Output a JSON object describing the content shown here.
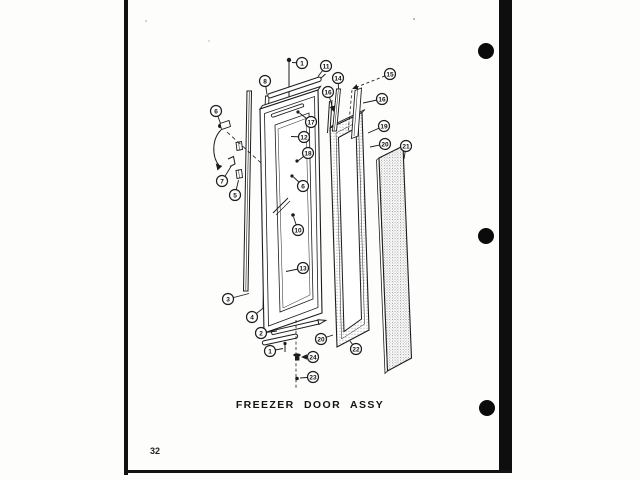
{
  "page": {
    "title": "FREEZER DOOR ASSY",
    "page_number": "32"
  },
  "diagram": {
    "name": "freezer-door-assembly-exploded-view",
    "ink_color": "#1c1c1c",
    "callouts": [
      {
        "label": "1",
        "cx": 302,
        "cy": 63,
        "tx": 292,
        "ty": 62.5
      },
      {
        "label": "11",
        "cx": 326,
        "cy": 66,
        "tx": 318,
        "ty": 76.5
      },
      {
        "label": "8",
        "cx": 265,
        "cy": 81,
        "tx": 267,
        "ty": 94.5
      },
      {
        "label": "14",
        "cx": 338,
        "cy": 78,
        "tx": 338.5,
        "ty": 88.5
      },
      {
        "label": "15",
        "cx": 390,
        "cy": 74,
        "tx": 353,
        "ty": 88.5,
        "dashed": true,
        "arrow": true
      },
      {
        "label": "16",
        "cx": 328,
        "cy": 92,
        "tx": 333.5,
        "ty": 111,
        "arrow": true
      },
      {
        "label": "16",
        "cx": 382,
        "cy": 99,
        "tx": 363,
        "ty": 103
      },
      {
        "label": "17",
        "cx": 311,
        "cy": 122,
        "tx": 299.5,
        "ty": 113
      },
      {
        "label": "12",
        "cx": 304,
        "cy": 137,
        "tx": 291,
        "ty": 136.5
      },
      {
        "label": "18",
        "cx": 308,
        "cy": 153,
        "tx": 298.5,
        "ty": 160.5
      },
      {
        "label": "6",
        "cx": 303,
        "cy": 186,
        "tx": 293.5,
        "ty": 177
      },
      {
        "label": "6",
        "cx": 216,
        "cy": 111,
        "tx": 220.5,
        "ty": 123.5
      },
      {
        "label": "7",
        "cx": 222,
        "cy": 181,
        "tx": 231,
        "ty": 166.5
      },
      {
        "label": "5",
        "cx": 235,
        "cy": 195,
        "tx": 238.5,
        "ty": 180
      },
      {
        "label": "10",
        "cx": 298,
        "cy": 230,
        "tx": 293.5,
        "ty": 217
      },
      {
        "label": "13",
        "cx": 303,
        "cy": 268,
        "tx": 286,
        "ty": 271.5
      },
      {
        "label": "3",
        "cx": 228,
        "cy": 299,
        "tx": 249,
        "ty": 293.5
      },
      {
        "label": "4",
        "cx": 252,
        "cy": 317,
        "tx": 264,
        "ty": 307.5
      },
      {
        "label": "2",
        "cx": 261,
        "cy": 333,
        "tx": 277,
        "ty": 331
      },
      {
        "label": "1",
        "cx": 270,
        "cy": 351,
        "tx": 283,
        "ty": 348.5
      },
      {
        "label": "20",
        "cx": 321,
        "cy": 339,
        "tx": 333,
        "ty": 335
      },
      {
        "label": "22",
        "cx": 356,
        "cy": 349,
        "tx": 350,
        "ty": 341
      },
      {
        "label": "24",
        "cx": 313,
        "cy": 357,
        "tx": 302,
        "ty": 357,
        "arrow": true
      },
      {
        "label": "23",
        "cx": 313,
        "cy": 377,
        "tx": 300,
        "ty": 378
      },
      {
        "label": "19",
        "cx": 384,
        "cy": 126,
        "tx": 368,
        "ty": 133
      },
      {
        "label": "20",
        "cx": 385,
        "cy": 144,
        "tx": 370,
        "ty": 147
      },
      {
        "label": "21",
        "cx": 406,
        "cy": 146,
        "tx": 404,
        "ty": 159
      }
    ]
  },
  "binder": {
    "hole_color": "#0b0b0b",
    "holes": [
      {
        "cx": 486,
        "cy": 51
      },
      {
        "cx": 486,
        "cy": 236
      },
      {
        "cx": 487,
        "cy": 408
      }
    ]
  }
}
